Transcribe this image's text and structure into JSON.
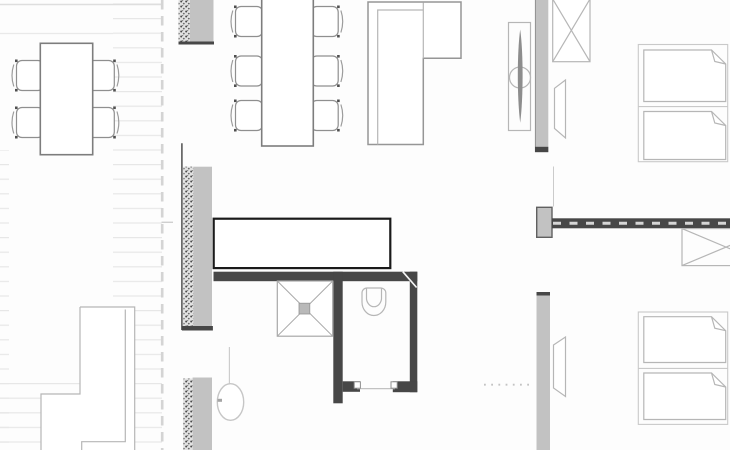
{
  "palette": {
    "bg": "#fdfdfd",
    "stripe": "#e7e7e7",
    "guide-line": "#d4d4d4",
    "line-light": "#b6b6b6",
    "line-medium": "#969696",
    "line-furniture": "#7d7d7d",
    "chair-dot": "#4f4f4f",
    "wall-gray": "#c2c2c2",
    "wall-dark": "#474747",
    "stipple-dot": "#4a4a4a",
    "stipple-bg": "#e2e2e2",
    "blade-gray": "#8d8d8d",
    "annotation-border": "#1a1a1a",
    "shower-drain": "#b9b9b9"
  },
  "drawing": {
    "type": "architectural-floor-plan",
    "annotation_rectangle": {
      "x": 214,
      "y": 219,
      "width": 177,
      "height": 49
    },
    "fixtures": [
      "dining-table-with-4-chairs",
      "long-table-with-6-chairs",
      "kitchen-counter-l-shape",
      "insulated-wall-segments",
      "radiator-fixture",
      "shaft-box-crossed",
      "wall-niche-panels",
      "partition-wall-with-pier",
      "crossed-rectangle-desk",
      "four-beds-with-folded-blankets",
      "bathroom-with-shower-and-toilet",
      "water-heater-circle",
      "stair-building-outline",
      "terrace-deck-stripes",
      "boundary-dashed-line"
    ]
  }
}
